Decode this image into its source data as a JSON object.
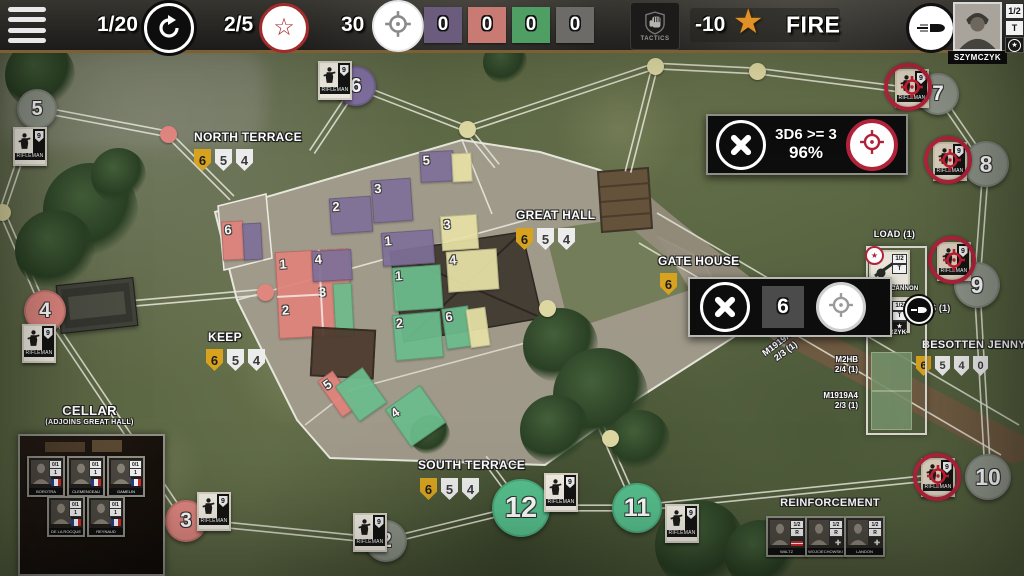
{
  "toolbar": {
    "turn": "1/20",
    "rounds": "2/5",
    "ammo": "30",
    "trackers": [
      {
        "value": "0",
        "color": "purple"
      },
      {
        "value": "0",
        "color": "red"
      },
      {
        "value": "0",
        "color": "green"
      },
      {
        "value": "0",
        "color": "gray"
      }
    ],
    "tactics_label": "TACTICS",
    "penalty": "-10",
    "fire_label": "FIRE",
    "commander": {
      "name": "SZYMCZYK",
      "ratio": "1/2",
      "letter": "T"
    }
  },
  "dialogs": {
    "attack": {
      "roll": "3D6 >= 3",
      "chance": "96%"
    },
    "move": {
      "value": "6"
    }
  },
  "colors": {
    "tracker_purple": "#6b5b7d",
    "tracker_red": "#c97a72",
    "tracker_green": "#4f9e63",
    "tracker_gray": "#6d6b68",
    "accent_red": "#b1233b",
    "shield_gold": "#d7a31f"
  },
  "map": {
    "unit_badge": "9",
    "unit_label": "RIFLEMAN",
    "locations": [
      {
        "name": "NORTH TERRACE",
        "x": 194,
        "y": 130,
        "sx": 194,
        "sy": 149,
        "shields": [
          "6",
          "5",
          "4"
        ]
      },
      {
        "name": "GREAT HALL",
        "x": 516,
        "y": 208,
        "sx": 516,
        "sy": 228,
        "shields": [
          "6",
          "5",
          "4"
        ]
      },
      {
        "name": "KEEP",
        "x": 208,
        "y": 330,
        "sx": 206,
        "sy": 349,
        "shields": [
          "6",
          "5",
          "4"
        ]
      },
      {
        "name": "SOUTH TERRACE",
        "x": 418,
        "y": 458,
        "sx": 420,
        "sy": 478,
        "shields": [
          "6",
          "5",
          "4"
        ]
      },
      {
        "name": "GATE HOUSE",
        "x": 658,
        "y": 254,
        "sx": 660,
        "sy": 273,
        "shields": [
          "6"
        ]
      },
      {
        "name": "BESOTTEN JENNY",
        "x": 922,
        "y": 339,
        "sx": 916,
        "sy": 356,
        "shields": [
          "6",
          "5",
          "4",
          "0"
        ],
        "small": true
      }
    ],
    "nodes": [
      {
        "n": "5",
        "x": 37,
        "y": 109,
        "r": 20,
        "c": "gray"
      },
      {
        "n": "6",
        "x": 356,
        "y": 86,
        "r": 20,
        "c": "purple"
      },
      {
        "n": "4",
        "x": 45,
        "y": 311,
        "r": 21,
        "c": "salmon"
      },
      {
        "n": "3",
        "x": 186,
        "y": 521,
        "r": 21,
        "c": "salmon"
      },
      {
        "n": "2",
        "x": 386,
        "y": 541,
        "r": 21,
        "c": "gray"
      },
      {
        "n": "12",
        "x": 521,
        "y": 508,
        "r": 29,
        "c": "green"
      },
      {
        "n": "11",
        "x": 637,
        "y": 508,
        "r": 25,
        "c": "green"
      },
      {
        "n": "7",
        "x": 938,
        "y": 94,
        "r": 21,
        "c": "gray"
      },
      {
        "n": "8",
        "x": 986,
        "y": 164,
        "r": 23,
        "c": "gray"
      },
      {
        "n": "9",
        "x": 977,
        "y": 285,
        "r": 23,
        "c": "gray"
      },
      {
        "n": "10",
        "x": 988,
        "y": 477,
        "r": 23,
        "c": "gray"
      }
    ],
    "dots": [
      {
        "x": 168,
        "y": 134,
        "c": "salmon"
      },
      {
        "x": 265,
        "y": 292,
        "c": "salmon"
      },
      {
        "x": 467,
        "y": 129,
        "c": "khaki"
      },
      {
        "x": 655,
        "y": 66,
        "c": "khaki"
      },
      {
        "x": 757,
        "y": 71,
        "c": "khaki"
      },
      {
        "x": 547,
        "y": 308,
        "c": "khaki"
      },
      {
        "x": 610,
        "y": 438,
        "c": "khaki"
      },
      {
        "x": 2,
        "y": 212,
        "c": "khaki"
      }
    ],
    "roads": [
      [
        37,
        109,
        168,
        134
      ],
      [
        168,
        134,
        232,
        198
      ],
      [
        356,
        86,
        312,
        152
      ],
      [
        356,
        86,
        467,
        129
      ],
      [
        467,
        129,
        497,
        166
      ],
      [
        467,
        129,
        655,
        66
      ],
      [
        655,
        66,
        757,
        71
      ],
      [
        655,
        66,
        628,
        172
      ],
      [
        757,
        71,
        938,
        94
      ],
      [
        938,
        94,
        986,
        164
      ],
      [
        986,
        164,
        977,
        285
      ],
      [
        977,
        285,
        988,
        477
      ],
      [
        2,
        212,
        37,
        109
      ],
      [
        2,
        212,
        45,
        311
      ],
      [
        45,
        311,
        265,
        292
      ],
      [
        45,
        311,
        186,
        521
      ],
      [
        186,
        521,
        386,
        541
      ],
      [
        386,
        541,
        521,
        508
      ],
      [
        521,
        508,
        637,
        508
      ],
      [
        637,
        508,
        940,
        477
      ],
      [
        521,
        508,
        484,
        458
      ],
      [
        637,
        508,
        598,
        420
      ]
    ],
    "tiles": [
      {
        "x": 222,
        "y": 221,
        "w": 22,
        "h": 39,
        "c": "red",
        "n": "6",
        "rot": -3
      },
      {
        "x": 243,
        "y": 223,
        "w": 19,
        "h": 37,
        "c": "purple",
        "rot": -3
      },
      {
        "x": 330,
        "y": 197,
        "w": 42,
        "h": 36,
        "c": "purple",
        "n": "2",
        "rot": -4
      },
      {
        "x": 372,
        "y": 179,
        "w": 40,
        "h": 43,
        "c": "purple",
        "n": "3",
        "rot": -4
      },
      {
        "x": 420,
        "y": 151,
        "w": 34,
        "h": 31,
        "c": "purple",
        "n": "5",
        "rot": -3
      },
      {
        "x": 452,
        "y": 153,
        "w": 20,
        "h": 29,
        "c": "yellow",
        "rot": -3
      },
      {
        "x": 382,
        "y": 231,
        "w": 52,
        "h": 34,
        "c": "purple",
        "n": "1",
        "rot": -4
      },
      {
        "x": 393,
        "y": 266,
        "w": 49,
        "h": 44,
        "c": "green",
        "n": "1",
        "rot": -4
      },
      {
        "x": 441,
        "y": 215,
        "w": 37,
        "h": 35,
        "c": "yellow",
        "n": "3",
        "rot": -4
      },
      {
        "x": 447,
        "y": 250,
        "w": 51,
        "h": 41,
        "c": "yellow",
        "n": "4",
        "rot": -4
      },
      {
        "x": 277,
        "y": 250,
        "w": 74,
        "h": 87,
        "c": "red",
        "rot": -3,
        "grid": true,
        "nums": [
          {
            "t": "1",
            "px": 4,
            "py": 6
          },
          {
            "t": "2",
            "px": 4,
            "py": 52
          },
          {
            "t": "3",
            "px": 42,
            "py": 36
          }
        ]
      },
      {
        "x": 312,
        "y": 250,
        "w": 40,
        "h": 31,
        "c": "purple",
        "n": "4",
        "rot": -3
      },
      {
        "x": 334,
        "y": 283,
        "w": 19,
        "h": 53,
        "c": "green",
        "rot": -3
      },
      {
        "x": 311,
        "y": 328,
        "w": 64,
        "h": 50,
        "c": "brown",
        "rot": 3
      },
      {
        "x": 394,
        "y": 313,
        "w": 48,
        "h": 46,
        "c": "green",
        "n": "2",
        "rot": -5
      },
      {
        "x": 444,
        "y": 307,
        "w": 27,
        "h": 41,
        "c": "green",
        "n": "6",
        "rot": -8
      },
      {
        "x": 468,
        "y": 308,
        "w": 20,
        "h": 39,
        "c": "yellow",
        "rot": -8
      },
      {
        "x": 328,
        "y": 372,
        "w": 19,
        "h": 44,
        "c": "red",
        "n": "5",
        "rot": -35
      },
      {
        "x": 344,
        "y": 373,
        "w": 34,
        "h": 43,
        "c": "green",
        "rot": -35
      },
      {
        "x": 394,
        "y": 393,
        "w": 43,
        "h": 46,
        "c": "green",
        "n": "4",
        "rot": -35
      }
    ],
    "counters": [
      {
        "x": 318,
        "y": 61,
        "type": "friendly"
      },
      {
        "x": 13,
        "y": 127,
        "type": "friendly"
      },
      {
        "x": 22,
        "y": 324,
        "type": "friendly"
      },
      {
        "x": 197,
        "y": 492,
        "type": "friendly"
      },
      {
        "x": 353,
        "y": 513,
        "type": "friendly"
      },
      {
        "x": 544,
        "y": 473,
        "type": "friendly"
      },
      {
        "x": 665,
        "y": 504,
        "type": "friendly"
      },
      {
        "x": 895,
        "y": 69,
        "type": "enemy",
        "rx": 908,
        "ry": 87
      },
      {
        "x": 933,
        "y": 142,
        "type": "enemy",
        "rx": 948,
        "ry": 160
      },
      {
        "x": 937,
        "y": 242,
        "type": "enemy",
        "rx": 952,
        "ry": 260
      },
      {
        "x": 921,
        "y": 458,
        "type": "enemy",
        "rx": 937,
        "ry": 477
      }
    ]
  },
  "load_panel": {
    "title": "LOAD (1)",
    "weapon": "76MM CANNON",
    "crew": "SZYMCZYK",
    "crew_ratio": "1/2",
    "crew_letter": "T",
    "ammo": "6 (1)",
    "mounts": [
      {
        "name": "M2HB",
        "stat": "2/4 (1)"
      },
      {
        "name": "M1919A4",
        "stat": "2/3 (1)"
      }
    ]
  },
  "map_weapon_label": {
    "name": "M1919A4",
    "stat": "2/3 (1)"
  },
  "cellar": {
    "title": "CELLAR",
    "subtitle": "(ADJOINS GREAT HALL)",
    "stat1": "0/1",
    "stat2": "1",
    "units": [
      {
        "name": "BOROTRA"
      },
      {
        "name": "CLEMENCEAU"
      },
      {
        "name": "GAMELIN"
      },
      {
        "name": "DE LA ROCQUE"
      },
      {
        "name": "REYNAUD"
      }
    ]
  },
  "reinforcement": {
    "title": "REINFORCEMENT",
    "stat1": "1/2",
    "stat2": "R",
    "units": [
      {
        "name": "WALTZ",
        "ribbon": true
      },
      {
        "name": "WOJCIECHOWSKI"
      },
      {
        "name": "LANDON"
      }
    ]
  }
}
